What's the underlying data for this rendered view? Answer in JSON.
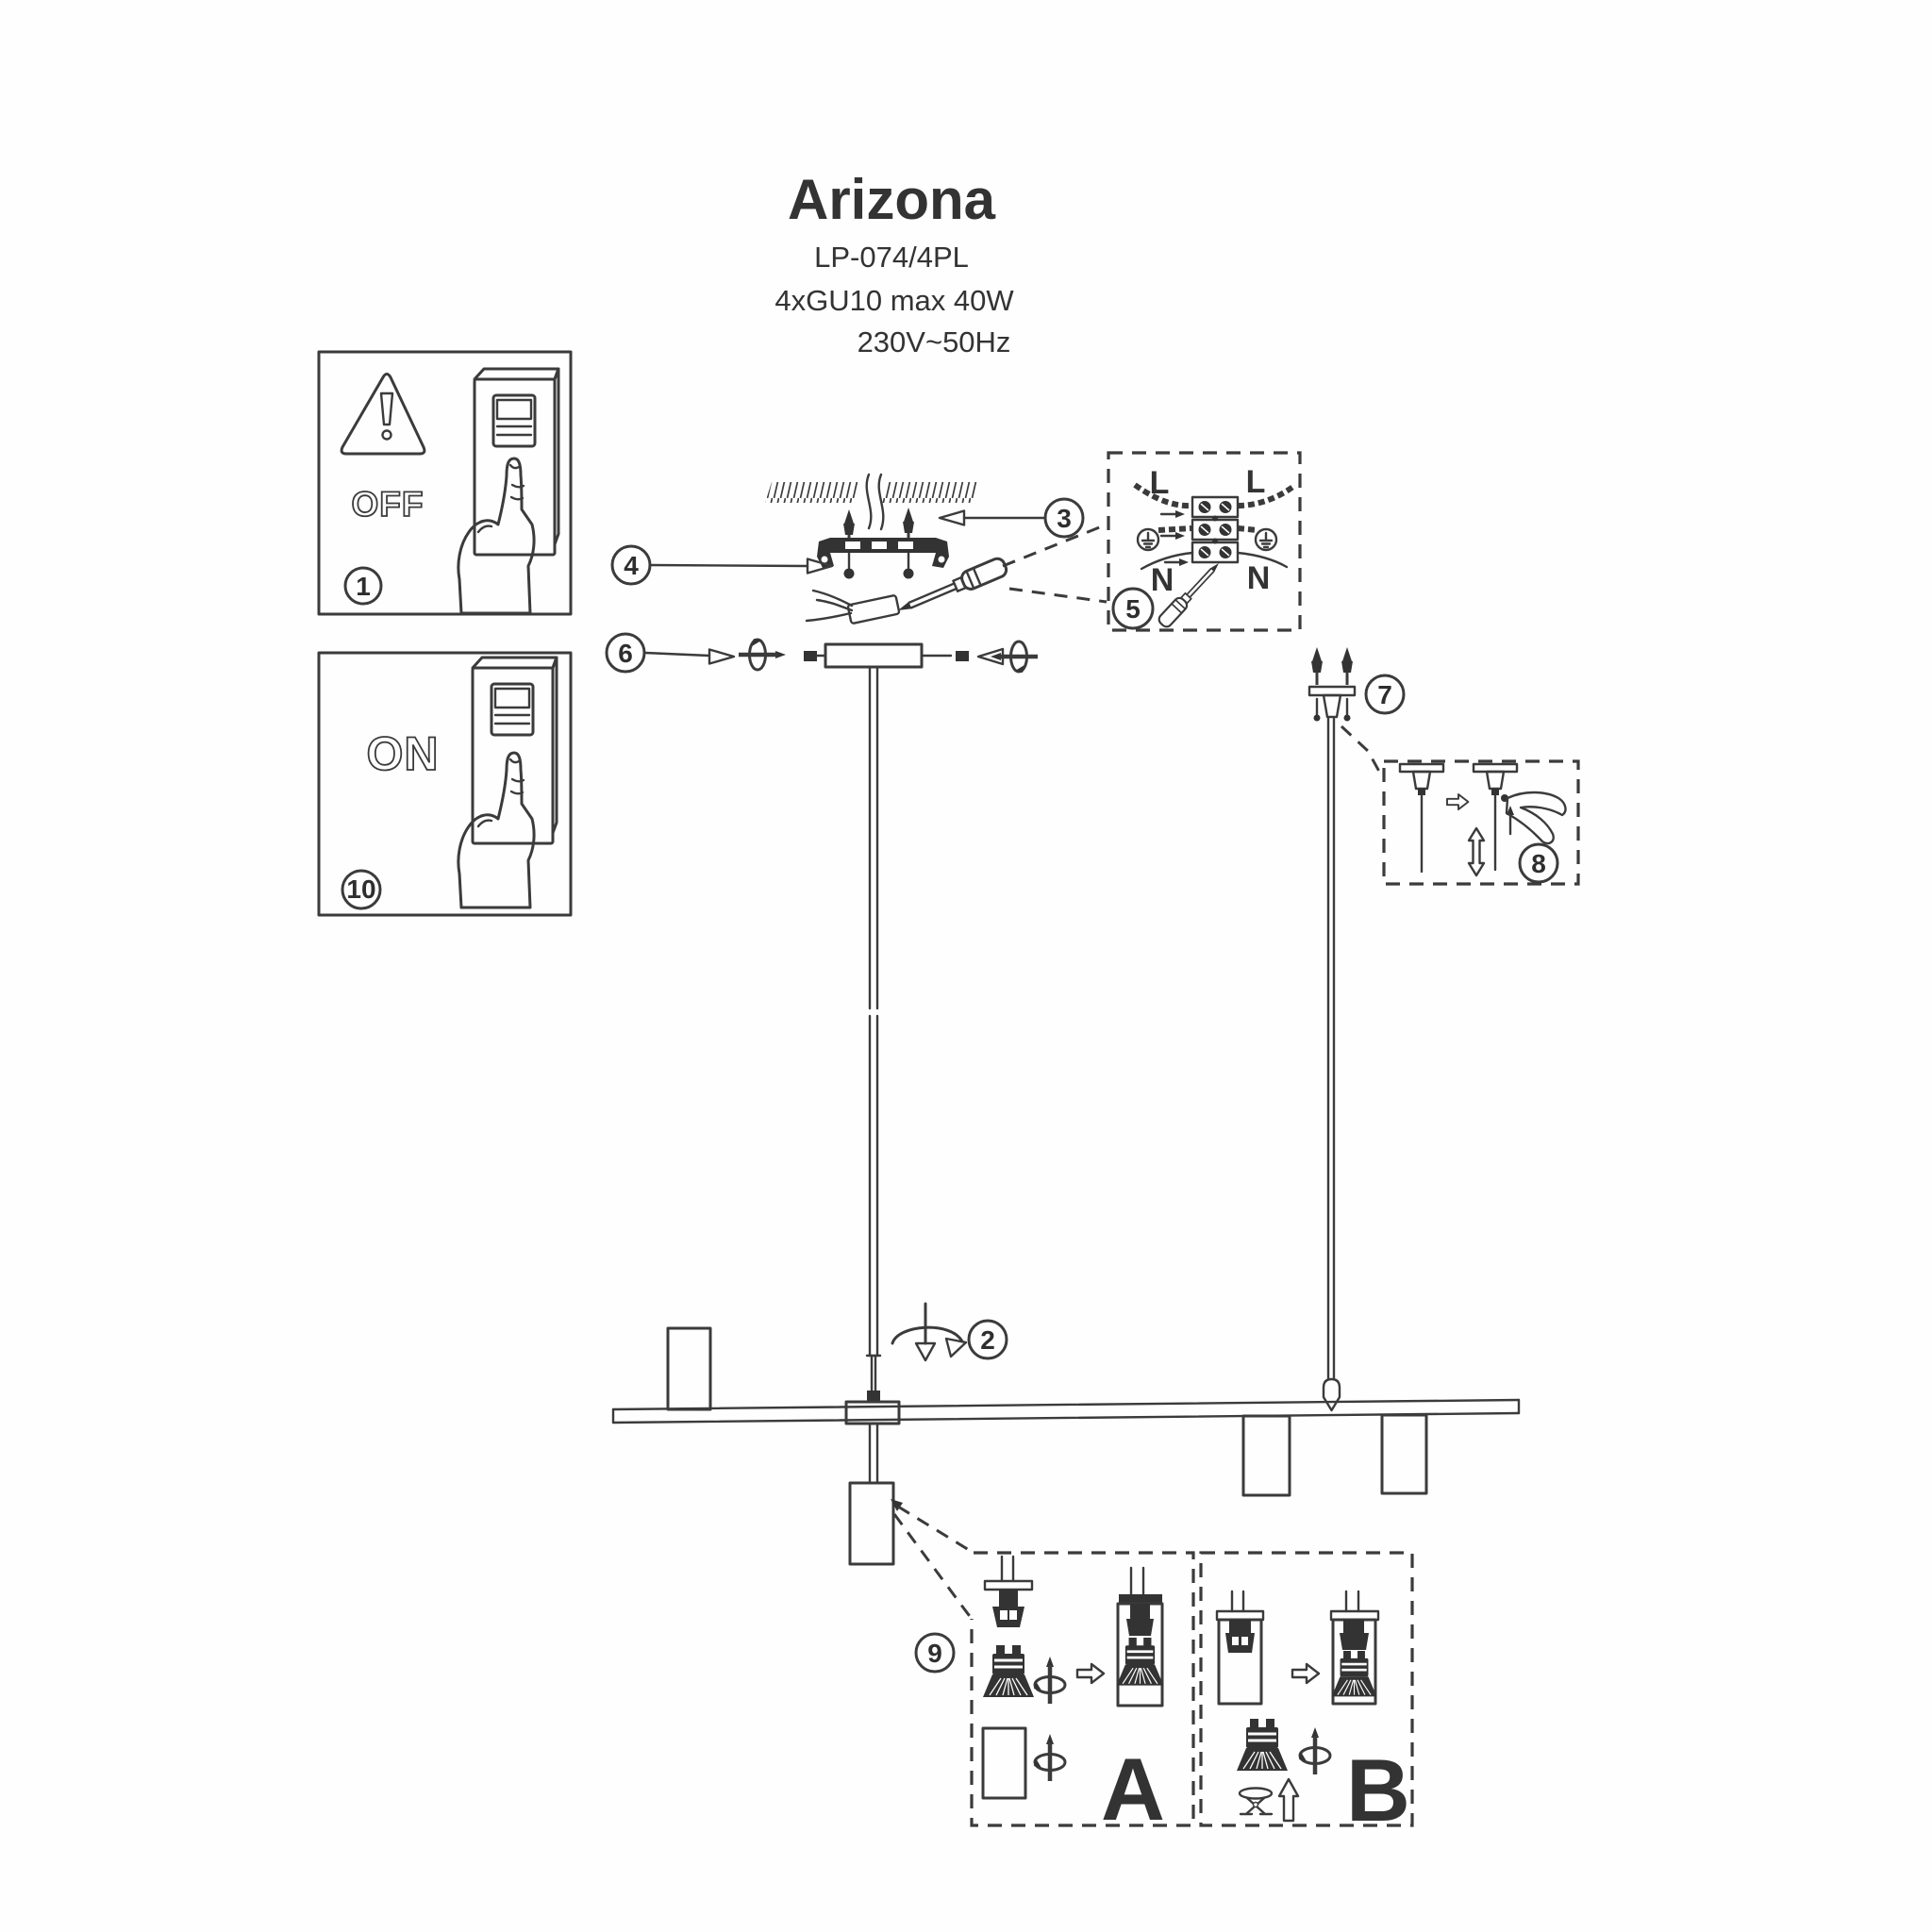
{
  "header": {
    "title": "Arizona",
    "model": "LP-074/4PL",
    "lamp_spec": "4xGU10 max 40W",
    "power_spec": "230V~50Hz"
  },
  "panels": {
    "power_off": {
      "label": "OFF"
    },
    "power_on": {
      "label": "ON"
    }
  },
  "steps": {
    "power_off": "1",
    "rotate_rod": "2",
    "ceiling_plugs": "3",
    "bracket": "4",
    "wiring": "5",
    "canopy_screws": "6",
    "cable_grip": "7",
    "cable_adjust": "8",
    "bulbs": "9",
    "power_on": "10"
  },
  "wiring_box": {
    "live_left": "L",
    "live_right": "L",
    "neutral_left": "N",
    "neutral_right": "N"
  },
  "bulb_box": {
    "variant_a": "A",
    "variant_b": "B"
  },
  "colors": {
    "ink": "#3b3b3b",
    "dark_fill": "#333333",
    "paper": "#fefefe"
  }
}
